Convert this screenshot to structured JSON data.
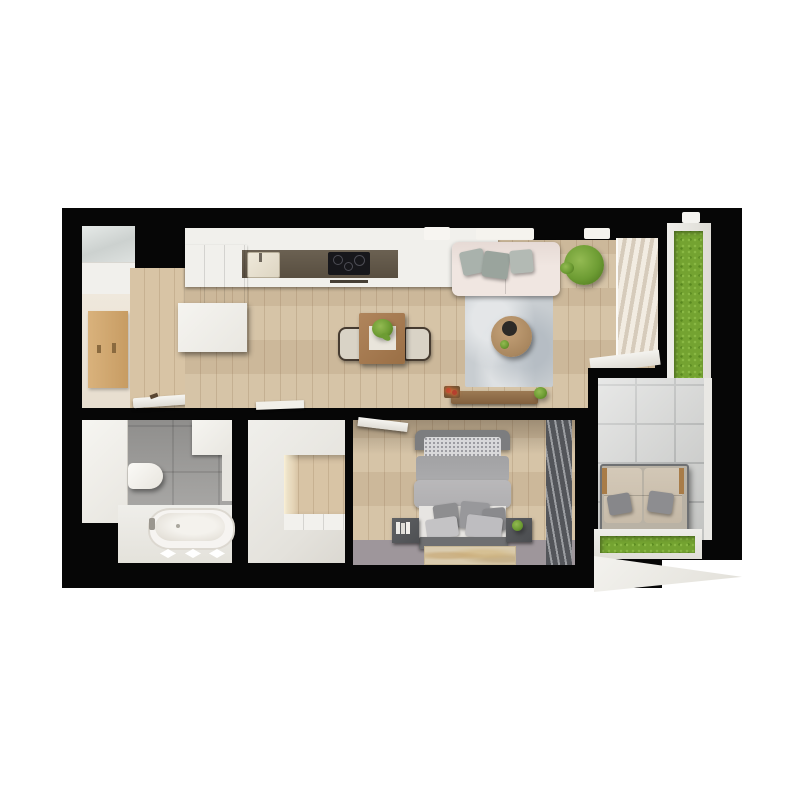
{
  "scene": {
    "title": "apartment-floor-plan-3d-top-view",
    "background_color": "#ffffff",
    "wall_color": "#060606"
  },
  "palette": {
    "wood_floor": "#d3c0a2",
    "entry_cream_floor": "#ebe3d6",
    "kitchen_cabinet_white": "#f2f1ed",
    "kitchen_counter_dark": "#61574a",
    "cooktop_black": "#17171b",
    "dining_table_wood": "#a87c50",
    "sofa_upholstery": "#ebe1dc",
    "sofa_pillow_gray_green": "#a9b2ac",
    "living_rug": "#c8cdd1",
    "coffee_table_wood": "#b3906a",
    "grass_green": "#74a331",
    "balcony_marble_tile": "#cbccca",
    "outdoor_cushion_beige": "#cfc3b1",
    "bathroom_tile_gray": "#a3a2a0",
    "sanitary_white": "#f5f3ef",
    "closet_white": "#edece8",
    "closet_nook_wood": "#cdb795",
    "bed_headboard": "#7c7d7f",
    "bed_duvet": "#b5b4b6",
    "bed_sheet_white": "#e7e5e2",
    "bedroom_floor_accent": "#9e969b",
    "bedroom_blinds_dark": "#54565a",
    "bedroom_rug_beige": "#d9cbae",
    "candle_red": "#b5402e"
  },
  "rooms": [
    {
      "name": "entry-hall"
    },
    {
      "name": "kitchen-living-room"
    },
    {
      "name": "bathroom"
    },
    {
      "name": "walk-in-closet"
    },
    {
      "name": "bedroom"
    },
    {
      "name": "balcony"
    }
  ],
  "furniture": {
    "entry_hall": [
      "glass-wardrobe",
      "coat-panel",
      "open-entrance-door"
    ],
    "kitchen": [
      "counter-with-sink",
      "cooktop",
      "utensil-rail",
      "base-cabinets",
      "island-block"
    ],
    "dining": [
      "wood-table",
      "chair-left",
      "chair-right",
      "plant-centerpiece",
      "placemat"
    ],
    "living": [
      "sofa-with-cushions",
      "area-rug",
      "round-coffee-table",
      "potted-plant",
      "media-bench",
      "red-candles",
      "window-blinds",
      "windowsill",
      "ceiling-lamps"
    ],
    "bathroom": [
      "toilet",
      "bathtub",
      "tall-cabinet-left",
      "upper-cabinet",
      "deck-lights"
    ],
    "walk_in_closet": [
      "white-wardrobe-units",
      "wood-nook",
      "shelf-band"
    ],
    "bedroom": [
      "double-bed",
      "headboard",
      "sparkle-pillow-band",
      "duvet",
      "pillows",
      "nightstand-left-with-books",
      "nightstand-right-with-plant",
      "footboard-bench",
      "foot-rug",
      "dark-blinds",
      "open-door"
    ],
    "balcony": [
      "marble-tile-floor",
      "outdoor-loveseat",
      "grass-panel-vertical",
      "grass-panel-horizontal",
      "white-ledge"
    ]
  }
}
